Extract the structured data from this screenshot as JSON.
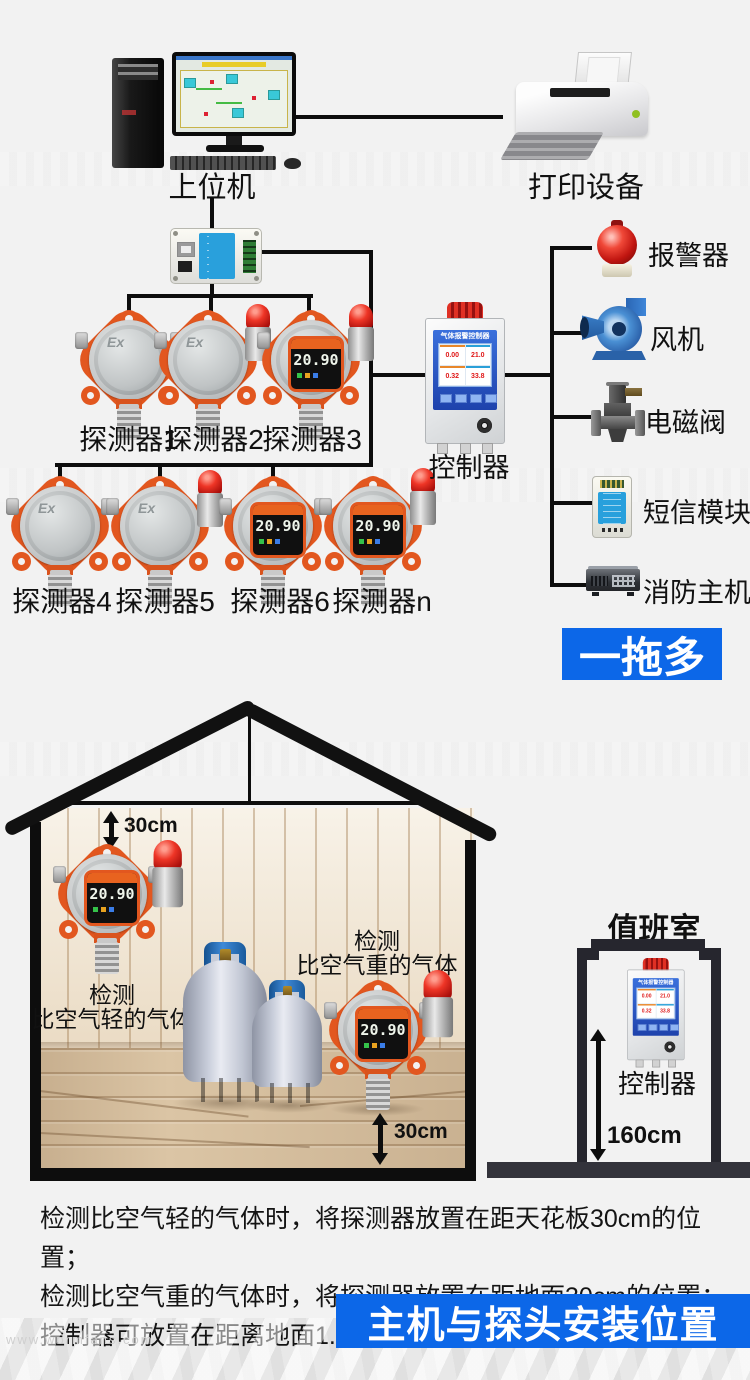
{
  "colors": {
    "accent_blue": "#0c67e8",
    "line_black": "#0d0d0d",
    "detector_orange": "#e2571f",
    "beacon_red": "#c01510",
    "background": "#f2f2f2"
  },
  "top": {
    "host_label": "上位机",
    "printer_label": "打印设备",
    "ex_mark": "Ex",
    "display_value": "20.90",
    "detectors_row1": [
      "探测器1",
      "探测器2",
      "探测器3"
    ],
    "detectors_row2": [
      "探测器4",
      "探测器5",
      "探测器6",
      "探测器n"
    ],
    "controller": {
      "label": "控制器",
      "screen_title": "气体报警控制器",
      "readings": [
        "0.00",
        "21.0",
        "0.32",
        "33.8"
      ]
    },
    "outputs": [
      {
        "label": "报警器"
      },
      {
        "label": "风机"
      },
      {
        "label": "电磁阀"
      },
      {
        "label": "短信模块"
      },
      {
        "label": "消防主机"
      }
    ],
    "banner": "一拖多"
  },
  "install": {
    "ceiling_gap": "30cm",
    "floor_gap": "30cm",
    "light_gas_line1": "检测",
    "light_gas_line2": "比空气轻的气体",
    "heavy_gas_line1": "检测",
    "heavy_gas_line2": "比空气重的气体",
    "duty_room": "值班室",
    "duty_controller": "控制器",
    "controller_height": "160cm"
  },
  "notes": {
    "line1": "检测比空气轻的气体时，将探测器放置在距天花板30cm的位置；",
    "line2": "检测比空气重的气体时，将探测器放置在距地面30cm的位置；",
    "line3": "控制器可放置在距离地面1.6米的位置。"
  },
  "bottom_banner": "主机与探头安装位置",
  "watermark": "www.wormfans.com"
}
